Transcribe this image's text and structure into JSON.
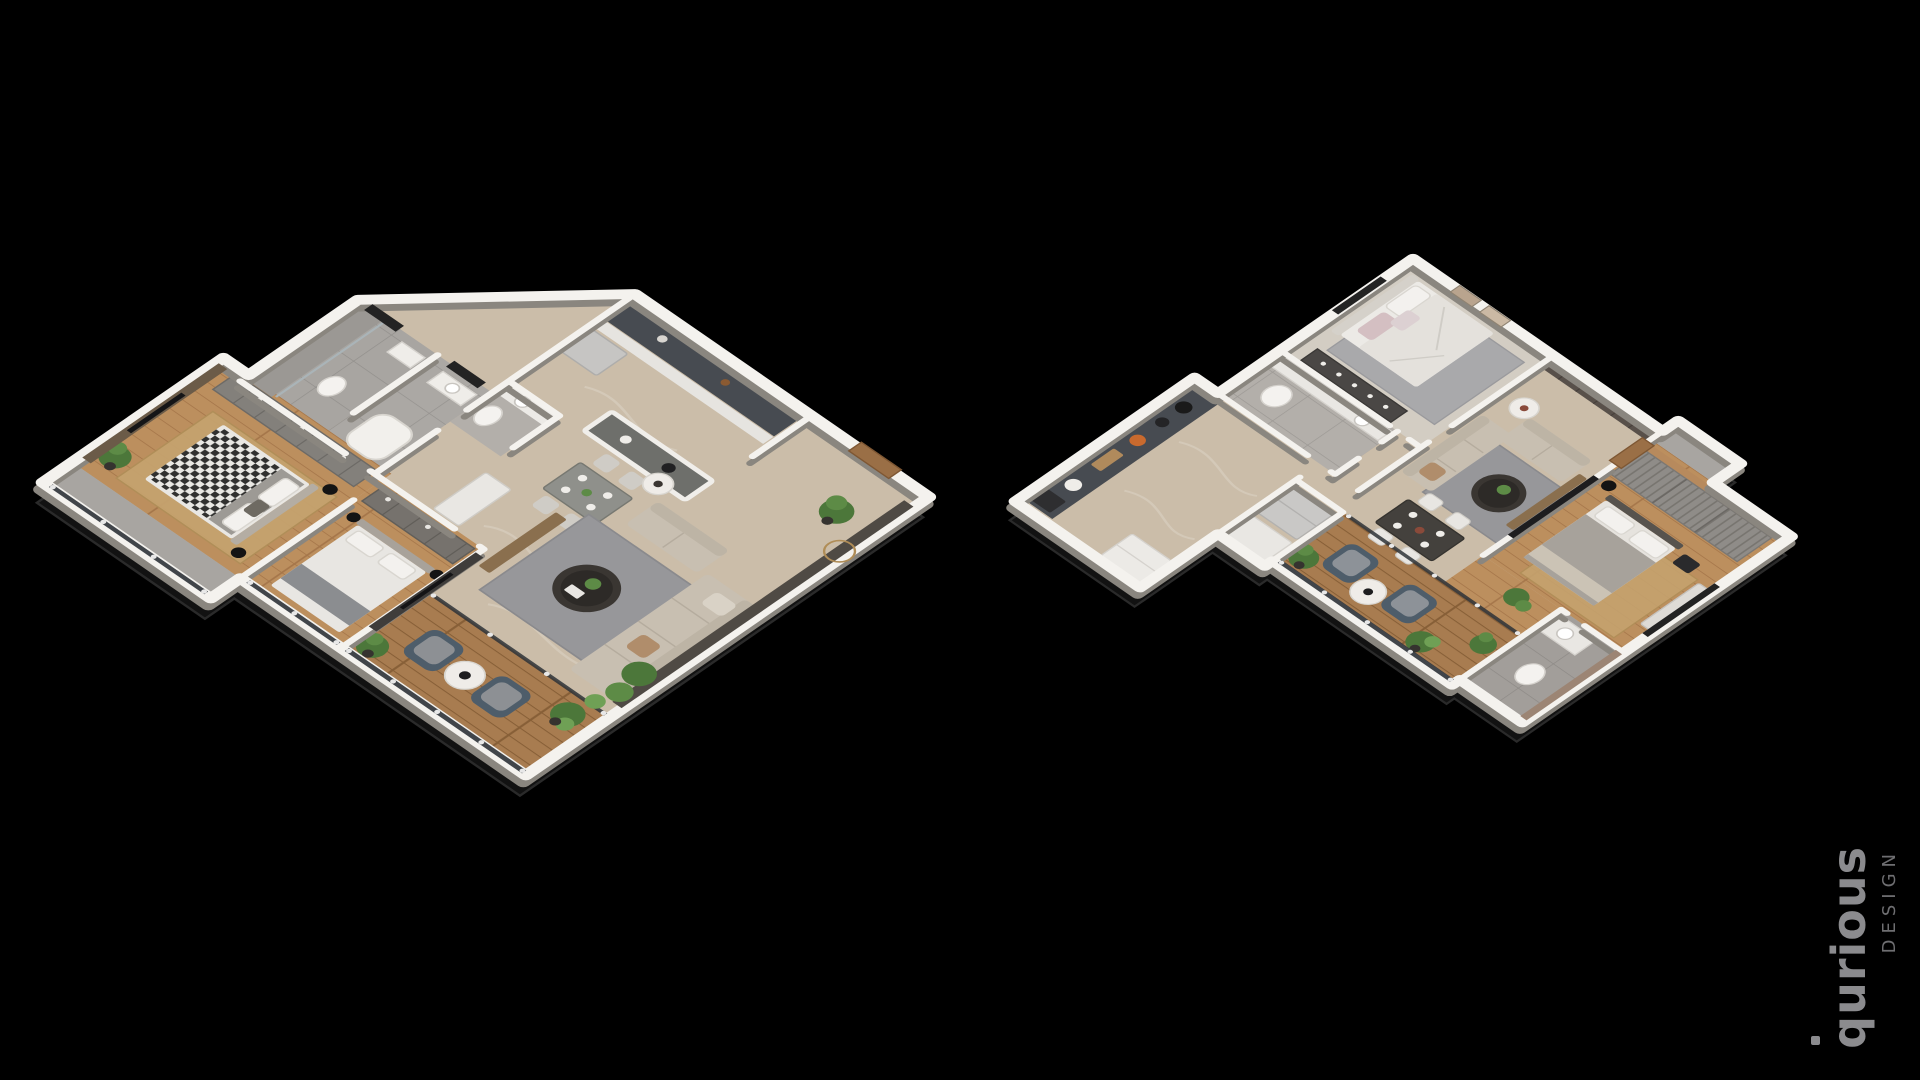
{
  "canvas": {
    "width": 1920,
    "height": 1080,
    "background": "#000000"
  },
  "watermark": {
    "brand": "qurious",
    "subtitle": "DESIGN",
    "brand_color": "#8b8b8e",
    "subtitle_color": "#6e6e71",
    "orientation": "vertical-bottom-to-top",
    "position": "bottom-right"
  },
  "scene": {
    "description": "Two isometric 3D apartment floor-plan renders on a black background",
    "plans": [
      {
        "id": "plan-left",
        "rooms": [
          "kitchen",
          "entry-hall",
          "shower-bathroom",
          "bathroom",
          "powder-wc",
          "master-bedroom",
          "second-bedroom",
          "living-dining-area",
          "main-balcony",
          "bedroom-balcony"
        ]
      },
      {
        "id": "plan-right",
        "rooms": [
          "bedroom-1",
          "foyer-wardrobe",
          "living-area",
          "dining-area",
          "bedroom-2",
          "bathroom",
          "ensuite-bathroom",
          "kitchen",
          "balcony",
          "utility-nook"
        ]
      }
    ]
  },
  "palette": {
    "background": "#000000",
    "wall": "#f4f2ee",
    "wall_shadow": "#8a867f",
    "marble_floor": "#cbbda9",
    "wood_floor": "#bc8f5e",
    "deck_floor": "#a87c50",
    "tile_floor": "#a8a5a1",
    "marble_bath_wall": "#9c8574",
    "counter_dark": "#474b51",
    "sofa_beige": "#c8bfb1",
    "rug_gray": "#97979a",
    "rug_tan": "#c5a26e",
    "armchair_slate": "#4e5d6a",
    "armchair_gray": "#7e848c",
    "plant_green": "#4c773a",
    "table_dark": "#3a3632",
    "door_wood": "#9a6f46",
    "glass_dark": "#2e3237",
    "accent_wall_dark": "#4f4a44"
  }
}
